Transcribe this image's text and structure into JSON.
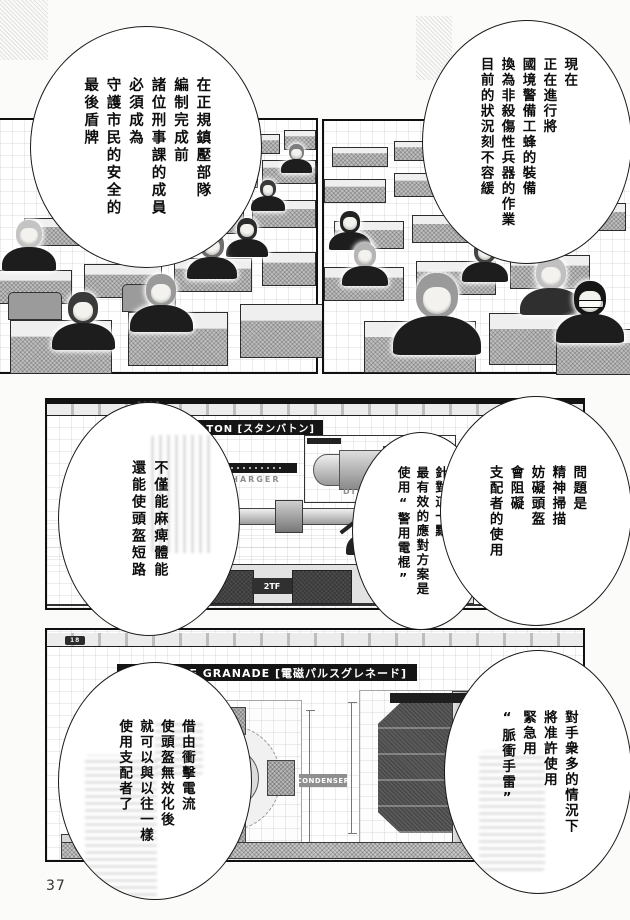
{
  "page": {
    "number": "37"
  },
  "panels": {
    "lecture_left": {
      "bubble": {
        "lines": [
          "在正規鎮壓部隊",
          "編制完成前",
          "諸位刑事課的成員",
          "必須成為",
          "守護市民的安全的",
          "最後盾牌"
        ]
      }
    },
    "lecture_right": {
      "bubble": {
        "lines": [
          "現在",
          "正在進行將",
          "國境警備工蜂的裝備",
          "換為非殺傷性兵器的作業",
          "目前的狀況刻不容緩"
        ]
      }
    },
    "stun_baton": {
      "serial": "0013",
      "title": "ATON [スタンバトン]",
      "discharger": "DISCHARGER",
      "code": "017-2",
      "tag": "2TF",
      "bubbles": {
        "problem": {
          "lines": [
            "問題是",
            "精神掃描",
            "妨礙頭盔",
            "會阻礙",
            "支配者的使用"
          ]
        },
        "solution": {
          "lines": [
            "針對這一點",
            "最有效的應對方案是",
            "使用“警用電棍”"
          ]
        },
        "effect": {
          "lines": [
            "不僅能麻痺體能",
            "還能使頭盔短路"
          ]
        }
      }
    },
    "pulse_granade": {
      "serial": "18",
      "title": "C PULSE GRANADE [電磁パルスグレネード]",
      "condenser": "CONDENSER",
      "bubbles": {
        "usage": {
          "lines": [
            "對手衆多的情況下",
            "將准許使用",
            "緊急用",
            "“脈衝手雷”"
          ]
        },
        "effect": {
          "lines": [
            "借由衝擊電流",
            "使頭盔無效化後",
            "就可以與以往一樣",
            "使用支配者了"
          ]
        }
      }
    }
  }
}
